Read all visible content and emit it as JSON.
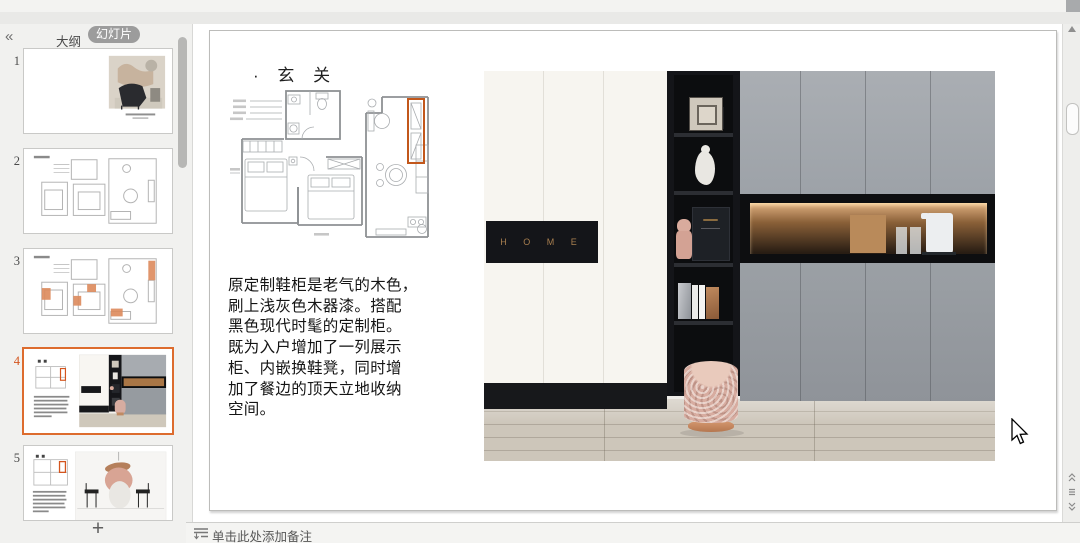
{
  "sidebar": {
    "collapse": "«",
    "tab_outline": "大纲",
    "tab_slides": "幻灯片",
    "add_label": "+",
    "slides": [
      {
        "num": "1"
      },
      {
        "num": "2"
      },
      {
        "num": "3"
      },
      {
        "num": "4"
      },
      {
        "num": "5"
      }
    ]
  },
  "slide": {
    "title": "· 玄 关",
    "body": "原定制鞋柜是老气的木色，\n刷上浅灰色木器漆。搭配\n黑色现代时髦的定制柜。\n既为入户增加了一列展示\n柜、内嵌换鞋凳，同时增\n加了餐边的顶天立地收纳\n空间。",
    "home_sign": "H O M E"
  },
  "notes": {
    "placeholder": "单击此处添加备注"
  },
  "colors": {
    "accent": "#d4551e",
    "selected_border": "#dd6c2e"
  }
}
